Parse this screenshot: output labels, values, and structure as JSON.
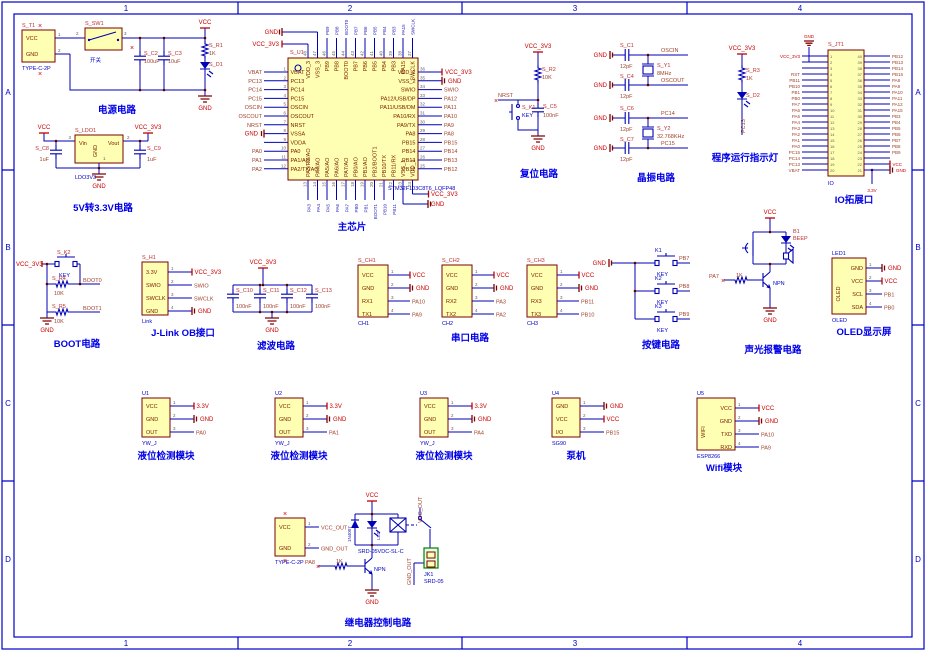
{
  "sheet": {
    "zones_h": [
      "1",
      "2",
      "3",
      "4"
    ],
    "zones_v": [
      "A",
      "B",
      "C",
      "D"
    ]
  },
  "captions": {
    "power": "电源电路",
    "ldo": "5V转3.3V电路",
    "chip": "主芯片",
    "reset": "复位电路",
    "crystal": "晶振电路",
    "runled": "程序运行指示灯",
    "ioport": "IO拓展口",
    "boot": "BOOT电路",
    "jlink": "J-Link OB接口",
    "filter": "滤波电路",
    "serial": "串口电路",
    "keys": "按键电路",
    "alarm": "声光报警电路",
    "oled": "OLED显示屏",
    "yw": "液位检测模块",
    "pump": "泵机",
    "wifi": "Wifi模块",
    "relay": "继电器控制电路"
  },
  "power": {
    "vcc": "VCC",
    "gnd": "GND",
    "sw_ref": "S_SW1",
    "sw_label": "开关",
    "p2": "2",
    "p3": "3",
    "c2_ref": "S_C2",
    "c2_val": "100uF",
    "c3_ref": "S_C3",
    "c3_val": "10uF",
    "r1_ref": "S_R1",
    "r1_val": "1K",
    "d1_ref": "S_D1",
    "t1": {
      "refdes": "S_T1",
      "bottom": "TYPE-C-2P",
      "w": 33,
      "h": 32,
      "start": 8,
      "sp": 16,
      "len": 15,
      "pins": [
        {
          "name": "VCC",
          "num": "1",
          "t": "none"
        },
        {
          "name": "GND",
          "num": "2",
          "t": "none"
        }
      ]
    }
  },
  "ldo": {
    "vcc": "VCC",
    "vcc33": "VCC_3V3",
    "gnd": "GND",
    "refdes": "S_LDO1",
    "bottom": "LDO3V3",
    "vin": "Vin",
    "vout": "Vout",
    "gndpin": "GND",
    "p1": "1",
    "p2": "2",
    "p3": "3",
    "c8_ref": "S_C8",
    "c8_val": "1uF",
    "c9_ref": "S_C9",
    "c9_val": "1uF"
  },
  "chip": {
    "refdes": "S_U1",
    "part": "STM32F103C8T6_LQFP48",
    "left": [
      {
        "n": "VBAT",
        "num": "1",
        "net": "VBAT",
        "t": "net"
      },
      {
        "n": "PC13",
        "num": "2",
        "net": "PC13",
        "t": "net"
      },
      {
        "n": "PC14",
        "num": "3",
        "net": "PC14",
        "t": "net"
      },
      {
        "n": "PC15",
        "num": "4",
        "net": "PC15",
        "t": "net"
      },
      {
        "n": "OSCIN",
        "num": "5",
        "net": "OSCIN",
        "t": "net"
      },
      {
        "n": "OSCOUT",
        "num": "6",
        "net": "OSCOUT",
        "t": "net"
      },
      {
        "n": "NRST",
        "num": "7",
        "net": "NRST",
        "t": "net"
      },
      {
        "n": "VSSA",
        "num": "8",
        "net": "GND",
        "t": "gnd"
      },
      {
        "n": "VDDA",
        "num": "9",
        "net": "",
        "t": "none"
      },
      {
        "n": "PA0",
        "num": "10",
        "net": "PA0",
        "t": "net"
      },
      {
        "n": "PA1/AO",
        "num": "11",
        "net": "PA1",
        "t": "net"
      },
      {
        "n": "PA2/TX/AO",
        "num": "12",
        "net": "PA2",
        "t": "net"
      }
    ],
    "right": [
      {
        "n": "VDD_2",
        "num": "36",
        "net": "VCC_3V3",
        "t": "vcc"
      },
      {
        "n": "VSS_2",
        "num": "35",
        "net": "GND",
        "t": "gnd"
      },
      {
        "n": "SWIO",
        "num": "34",
        "net": "SWIO",
        "t": "net"
      },
      {
        "n": "PA12/USB/DP",
        "num": "33",
        "net": "PA12",
        "t": "net"
      },
      {
        "n": "PA11/USB/DM",
        "num": "32",
        "net": "PA11",
        "t": "net"
      },
      {
        "n": "PA10/RX",
        "num": "31",
        "net": "PA10",
        "t": "net"
      },
      {
        "n": "PA9/TX",
        "num": "30",
        "net": "PA9",
        "t": "net"
      },
      {
        "n": "PA8",
        "num": "29",
        "net": "PA8",
        "t": "net"
      },
      {
        "n": "PB15",
        "num": "28",
        "net": "PB15",
        "t": "net"
      },
      {
        "n": "PB14",
        "num": "27",
        "net": "PB14",
        "t": "net"
      },
      {
        "n": "PB13",
        "num": "26",
        "net": "PB13",
        "t": "net"
      },
      {
        "n": "PB12",
        "num": "25",
        "net": "PB12",
        "t": "net"
      }
    ],
    "top": [
      {
        "n": "VDD_3",
        "num": "48",
        "net": "VCC_3V3",
        "t": "vcc_h"
      },
      {
        "n": "VSS_3",
        "num": "47",
        "net": "GND",
        "t": "gnd_h"
      },
      {
        "n": "PB9",
        "num": "46",
        "net": "PB9",
        "t": "vnet"
      },
      {
        "n": "PB8",
        "num": "45",
        "net": "PB8",
        "t": "vnet"
      },
      {
        "n": "BOOT0",
        "num": "44",
        "net": "BOOT0",
        "t": "vnet"
      },
      {
        "n": "PB7",
        "num": "43",
        "net": "PB7",
        "t": "vnet"
      },
      {
        "n": "PB6",
        "num": "42",
        "net": "PB6",
        "t": "vnet"
      },
      {
        "n": "PB5",
        "num": "41",
        "net": "PB5",
        "t": "vnet"
      },
      {
        "n": "PB4",
        "num": "40",
        "net": "PB4",
        "t": "vnet"
      },
      {
        "n": "PB3",
        "num": "39",
        "net": "PB3",
        "t": "vnet"
      },
      {
        "n": "PA15",
        "num": "38",
        "net": "PA15",
        "t": "vnet"
      },
      {
        "n": "SWCLK",
        "num": "37",
        "net": "SWCLK",
        "t": "vnet"
      }
    ],
    "bottom": [
      {
        "n": "PA3/RX/AO",
        "num": "13",
        "net": "PA3",
        "t": "vnet"
      },
      {
        "n": "PA4/AO",
        "num": "14",
        "net": "PA4",
        "t": "vnet"
      },
      {
        "n": "PA5/AO",
        "num": "15",
        "net": "PA5",
        "t": "vnet"
      },
      {
        "n": "PA6/AO",
        "num": "16",
        "net": "PA6",
        "t": "vnet"
      },
      {
        "n": "PA7/AO",
        "num": "17",
        "net": "PA7",
        "t": "vnet"
      },
      {
        "n": "PB0/AO",
        "num": "18",
        "net": "PB0",
        "t": "vnet"
      },
      {
        "n": "PB1/AO",
        "num": "19",
        "net": "PB1",
        "t": "vnet"
      },
      {
        "n": "PB2/BOOT1",
        "num": "20",
        "net": "BOOT1",
        "t": "vnet"
      },
      {
        "n": "PB10/TX",
        "num": "21",
        "net": "PB10",
        "t": "vnet"
      },
      {
        "n": "PB11/RX",
        "num": "22",
        "net": "PB11",
        "t": "vnet"
      },
      {
        "n": "VSS_1",
        "num": "23",
        "net": "GND",
        "t": "gnd_b"
      },
      {
        "n": "VDD_1",
        "num": "24",
        "net": "VCC_3V3",
        "t": "vcc_b"
      }
    ]
  },
  "reset": {
    "vcc33": "VCC_3V3",
    "r2_ref": "S_R2",
    "r2_val": "10K",
    "nrst": "NRST",
    "k1_ref": "S_K1",
    "key": "KEY",
    "c5_ref": "S_C5",
    "c5_val": "100nF",
    "gnd": "GND"
  },
  "crystal": {
    "gnd": "GND",
    "c1_ref": "S_C1",
    "c1_val": "12pF",
    "c4_ref": "S_C4",
    "c4_val": "12pF",
    "y1_ref": "S_Y1",
    "y1_val": "8MHz",
    "oscin": "OSCIN",
    "oscout": "OSCOUT",
    "c6_ref": "S_C6",
    "c6_val": "12pF",
    "c7_ref": "S_C7",
    "c7_val": "12pF",
    "y2_ref": "S_Y2",
    "y2_val": "32.768KHz",
    "pc14": "PC14",
    "pc15": "PC15"
  },
  "runled": {
    "vcc33": "VCC_3V3",
    "r3_ref": "S_R3",
    "r3_val": "1K",
    "d2_ref": "S_D2",
    "net": "PC13"
  },
  "ioport": {
    "refdes": "S_JT1",
    "bottom": "IO",
    "gnd": "GND",
    "v33": "3.3V",
    "left": [
      {
        "num": "1",
        "net": "VCC_3V3",
        "t": "pwr"
      },
      {
        "num": "2",
        "net": "",
        "t": "none"
      },
      {
        "num": "3",
        "net": "",
        "t": "none"
      },
      {
        "num": "4",
        "net": "RST",
        "t": "net"
      },
      {
        "num": "5",
        "net": "PB11",
        "t": "net"
      },
      {
        "num": "6",
        "net": "PB10",
        "t": "net"
      },
      {
        "num": "7",
        "net": "PB1",
        "t": "net"
      },
      {
        "num": "8",
        "net": "PB0",
        "t": "net"
      },
      {
        "num": "9",
        "net": "PA7",
        "t": "net"
      },
      {
        "num": "10",
        "net": "PA6",
        "t": "net"
      },
      {
        "num": "11",
        "net": "PA5",
        "t": "net"
      },
      {
        "num": "12",
        "net": "PA4",
        "t": "net"
      },
      {
        "num": "13",
        "net": "PA3",
        "t": "net"
      },
      {
        "num": "14",
        "net": "PA2",
        "t": "net"
      },
      {
        "num": "15",
        "net": "PA1",
        "t": "net"
      },
      {
        "num": "16",
        "net": "PA0",
        "t": "net"
      },
      {
        "num": "17",
        "net": "PC15",
        "t": "net"
      },
      {
        "num": "18",
        "net": "PC14",
        "t": "net"
      },
      {
        "num": "19",
        "net": "PC13",
        "t": "net"
      },
      {
        "num": "20",
        "net": "VBAT",
        "t": "net"
      }
    ],
    "right": [
      {
        "num": "40",
        "net": "PB12",
        "t": "net"
      },
      {
        "num": "39",
        "net": "PB13",
        "t": "net"
      },
      {
        "num": "38",
        "net": "PB14",
        "t": "net"
      },
      {
        "num": "37",
        "net": "PB15",
        "t": "net"
      },
      {
        "num": "36",
        "net": "PA8",
        "t": "net"
      },
      {
        "num": "35",
        "net": "PA9",
        "t": "net"
      },
      {
        "num": "34",
        "net": "PA10",
        "t": "net"
      },
      {
        "num": "33",
        "net": "PA11",
        "t": "net"
      },
      {
        "num": "32",
        "net": "PA12",
        "t": "net"
      },
      {
        "num": "31",
        "net": "PA15",
        "t": "net"
      },
      {
        "num": "30",
        "net": "PB3",
        "t": "net"
      },
      {
        "num": "29",
        "net": "PB4",
        "t": "net"
      },
      {
        "num": "28",
        "net": "PB5",
        "t": "net"
      },
      {
        "num": "27",
        "net": "PB6",
        "t": "net"
      },
      {
        "num": "26",
        "net": "PB7",
        "t": "net"
      },
      {
        "num": "25",
        "net": "PB8",
        "t": "net"
      },
      {
        "num": "24",
        "net": "PB9",
        "t": "net"
      },
      {
        "num": "23",
        "net": "",
        "t": "none"
      },
      {
        "num": "22",
        "net": "VCC",
        "t": "vcc"
      },
      {
        "num": "21",
        "net": "GND",
        "t": "gnd"
      }
    ]
  },
  "boot": {
    "vcc33": "VCC_3V3",
    "k2_ref": "S_K2",
    "key": "KEY",
    "r4_ref": "S_R4",
    "r4_val": "10K",
    "boot0": "BOOT0",
    "r5_ref": "S_R5",
    "r5_val": "10K",
    "boot1": "BOOT1",
    "gnd": "GND"
  },
  "jlink": {
    "refdes": "S_H1",
    "bottom": "Link",
    "w": 26,
    "h": 53,
    "start": 10,
    "sp": 13,
    "len": 24,
    "pins": [
      {
        "name": "3.3V",
        "num": "1",
        "t": "vcc",
        "net": "VCC_3V3"
      },
      {
        "name": "SWIO",
        "num": "2",
        "t": "net",
        "net": "SWIO"
      },
      {
        "name": "SWCLK",
        "num": "3",
        "t": "net",
        "net": "SWCLK"
      },
      {
        "name": "GND",
        "num": "4",
        "t": "gnd",
        "net": "GND"
      }
    ]
  },
  "filter": {
    "vcc33": "VCC_3V3",
    "gnd": "GND",
    "c10": "S_C10",
    "c11": "S_C11",
    "c12": "S_C12",
    "c13": "S_C13",
    "val": "100nF"
  },
  "serial": {
    "ch1": {
      "refdes": "S_CH1",
      "bottom": "CH1",
      "w": 30,
      "h": 52,
      "start": 10,
      "sp": 13,
      "len": 22,
      "pins": [
        {
          "name": "VCC",
          "num": "1",
          "t": "vcc",
          "net": "VCC"
        },
        {
          "name": "GND",
          "num": "2",
          "t": "gnd",
          "net": "GND"
        },
        {
          "name": "RX1",
          "num": "3",
          "t": "net",
          "net": "PA10"
        },
        {
          "name": "TX1",
          "num": "4",
          "t": "net",
          "net": "PA9"
        }
      ]
    },
    "ch2": {
      "refdes": "S_CH2",
      "bottom": "CH2",
      "w": 30,
      "h": 52,
      "start": 10,
      "sp": 13,
      "len": 22,
      "pins": [
        {
          "name": "VCC",
          "num": "1",
          "t": "vcc",
          "net": "VCC"
        },
        {
          "name": "GND",
          "num": "2",
          "t": "gnd",
          "net": "GND"
        },
        {
          "name": "RX2",
          "num": "3",
          "t": "net",
          "net": "PA3"
        },
        {
          "name": "TX2",
          "num": "4",
          "t": "net",
          "net": "PA2"
        }
      ]
    },
    "ch3": {
      "refdes": "S_CH3",
      "bottom": "CH3",
      "w": 30,
      "h": 52,
      "start": 10,
      "sp": 13,
      "len": 22,
      "pins": [
        {
          "name": "VCC",
          "num": "1",
          "t": "vcc",
          "net": "VCC"
        },
        {
          "name": "GND",
          "num": "2",
          "t": "gnd",
          "net": "GND"
        },
        {
          "name": "RX3",
          "num": "3",
          "t": "net",
          "net": "PB11"
        },
        {
          "name": "TX3",
          "num": "4",
          "t": "net",
          "net": "PB10"
        }
      ]
    }
  },
  "keys": {
    "gnd": "GND",
    "k1": "K1",
    "k2": "K2",
    "k3": "K3",
    "key": "KEY",
    "pb7": "PB7",
    "pb8": "PB8",
    "pb9": "PB9"
  },
  "alarm": {
    "vcc": "VCC",
    "b1": "B1",
    "beep": "BEEP",
    "r_val": "1K",
    "pa7": "PA7",
    "npn": "NPN",
    "gnd": "GND"
  },
  "oled": {
    "refdes": "LED1",
    "blue": true,
    "bottom": "OLED",
    "side": "OLED",
    "align": "r",
    "w": 34,
    "h": 56,
    "start": 10,
    "sp": 13,
    "len": 16,
    "pins": [
      {
        "name": "GND",
        "num": "1",
        "t": "gnd",
        "net": "GND"
      },
      {
        "name": "VCC",
        "num": "2",
        "t": "vcc",
        "net": "VCC"
      },
      {
        "name": "SCL",
        "num": "3",
        "t": "net",
        "net": "PB1"
      },
      {
        "name": "SDA",
        "num": "4",
        "t": "net",
        "net": "PB0"
      }
    ]
  },
  "yw": [
    {
      "refdes": "U1",
      "blue": true,
      "bottom": "YW_J",
      "w": 28,
      "h": 39,
      "start": 8,
      "sp": 13,
      "len": 24,
      "pins": [
        {
          "name": "VCC",
          "num": "1",
          "t": "vcc",
          "net": "3.3V"
        },
        {
          "name": "GND",
          "num": "2",
          "t": "gnd",
          "net": "GND"
        },
        {
          "name": "OUT",
          "num": "3",
          "t": "net",
          "net": "PA0"
        }
      ]
    },
    {
      "refdes": "U2",
      "blue": true,
      "bottom": "YW_J",
      "w": 28,
      "h": 39,
      "start": 8,
      "sp": 13,
      "len": 24,
      "pins": [
        {
          "name": "VCC",
          "num": "1",
          "t": "vcc",
          "net": "3.3V"
        },
        {
          "name": "GND",
          "num": "2",
          "t": "gnd",
          "net": "GND"
        },
        {
          "name": "OUT",
          "num": "3",
          "t": "net",
          "net": "PA1"
        }
      ]
    },
    {
      "refdes": "U3",
      "blue": true,
      "bottom": "YW_J",
      "w": 28,
      "h": 39,
      "start": 8,
      "sp": 13,
      "len": 24,
      "pins": [
        {
          "name": "VCC",
          "num": "1",
          "t": "vcc",
          "net": "3.3V"
        },
        {
          "name": "GND",
          "num": "2",
          "t": "gnd",
          "net": "GND"
        },
        {
          "name": "OUT",
          "num": "3",
          "t": "net",
          "net": "PA4"
        }
      ]
    }
  ],
  "pump": {
    "refdes": "U4",
    "blue": true,
    "bottom": "SG90",
    "w": 28,
    "h": 39,
    "start": 8,
    "sp": 13,
    "len": 24,
    "pins": [
      {
        "name": "GND",
        "num": "1",
        "t": "gnd",
        "net": "GND"
      },
      {
        "name": "VCC",
        "num": "2",
        "t": "vcc",
        "net": "VCC"
      },
      {
        "name": "I/O",
        "num": "3",
        "t": "net",
        "net": "PB15"
      }
    ]
  },
  "wifi": {
    "refdes": "U5",
    "blue": true,
    "bottom": "ESP8266",
    "side": "WIFI",
    "align": "r",
    "w": 38,
    "h": 52,
    "start": 10,
    "sp": 13,
    "len": 24,
    "pins": [
      {
        "name": "VCC",
        "num": "1",
        "t": "vcc",
        "net": "VCC"
      },
      {
        "name": "GND",
        "num": "2",
        "t": "gnd",
        "net": "GND"
      },
      {
        "name": "TXD",
        "num": "3",
        "t": "net",
        "net": "PA10"
      },
      {
        "name": "RXD",
        "num": "4",
        "t": "net",
        "net": "PA9"
      }
    ]
  },
  "relay": {
    "vcc": "VCC",
    "gnd": "GND",
    "d_label": "1N4007",
    "led_label": "LED",
    "part": "SRD-05VDC-SL-C",
    "vcc_out": "VCC_OUT",
    "gnd_out": "GND_OUT",
    "jk1": "JK1",
    "jk1_part": "SRD-05",
    "npn": "NPN",
    "r_val": "1K",
    "pa8": "PA8",
    "t2": {
      "refdes": "",
      "bottom": "TYPE-C-2P",
      "w": 30,
      "h": 38,
      "start": 9,
      "sp": 21,
      "len": 14,
      "pins": [
        {
          "name": "VCC",
          "num": "1",
          "t": "net",
          "net": "VCC_OUT"
        },
        {
          "name": "GND",
          "num": "2",
          "t": "net",
          "net": "GND_OUT"
        }
      ]
    }
  }
}
